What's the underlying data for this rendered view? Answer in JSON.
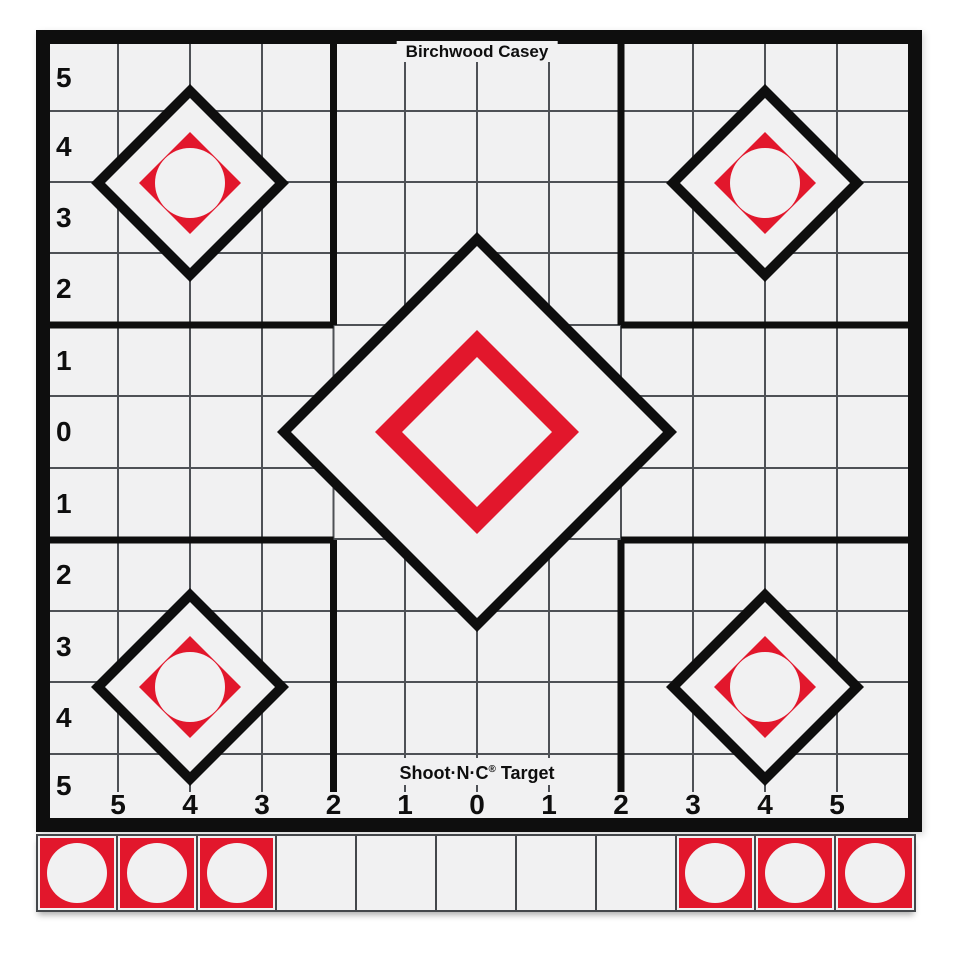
{
  "header": {
    "title": "Birchwood Casey"
  },
  "footer": {
    "brand": "Shoot·N·C",
    "reg": "®",
    "suffix": " Target"
  },
  "axes": {
    "left_labels": [
      "5",
      "4",
      "3",
      "2",
      "1",
      "0",
      "1",
      "2",
      "3",
      "4",
      "5"
    ],
    "bottom_labels": [
      "5",
      "4",
      "3",
      "2",
      "1",
      "0",
      "1",
      "2",
      "3",
      "4",
      "5"
    ]
  },
  "strip": {
    "pattern": [
      "patch",
      "patch",
      "patch",
      "blank",
      "blank",
      "blank",
      "blank",
      "blank",
      "patch",
      "patch",
      "patch"
    ]
  },
  "colors": {
    "red": "#e2172c",
    "ink": "#0e0e0e",
    "paper": "#f1f1f2",
    "grid": "#4e5156"
  }
}
